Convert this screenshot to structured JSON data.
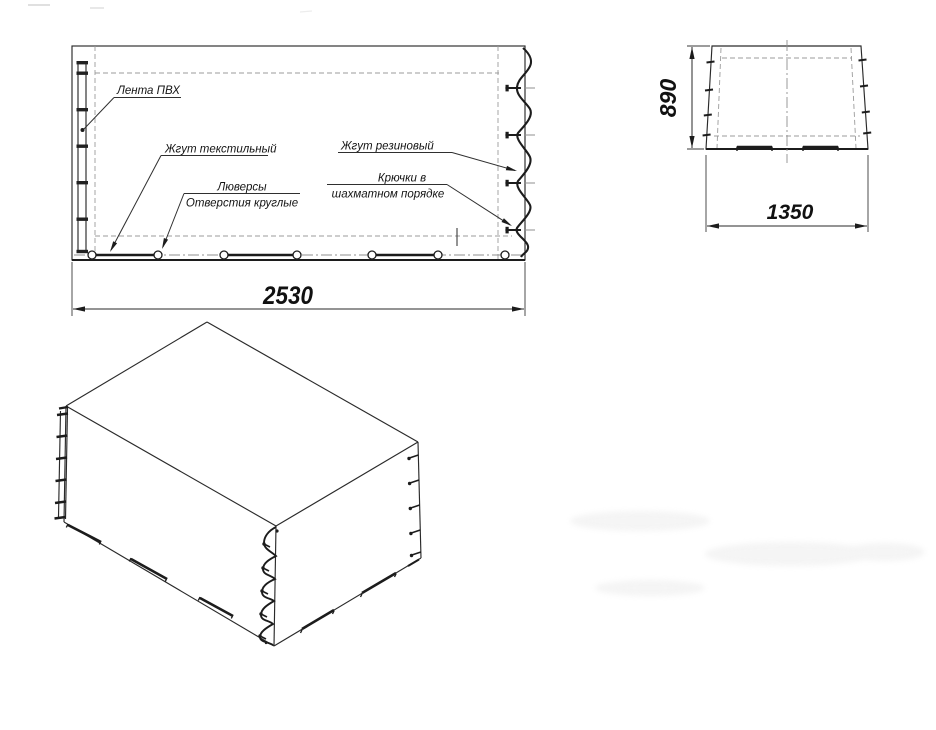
{
  "main_view": {
    "labels": {
      "pvc_tape": "Лента ПВХ",
      "textile_cord": "Жгут текстильный",
      "grommets_line1": "Люверсы",
      "grommets_line2": "Отверстия круглые",
      "rubber_cord": "Жгут резиновый",
      "hooks_line1": "Крючки в",
      "hooks_line2": "шахматном порядке"
    },
    "dimension_length": "2530"
  },
  "end_view": {
    "dimension_height": "890",
    "dimension_width": "1350"
  },
  "colors": {
    "line": "#1c1c1c",
    "background": "#ffffff"
  }
}
